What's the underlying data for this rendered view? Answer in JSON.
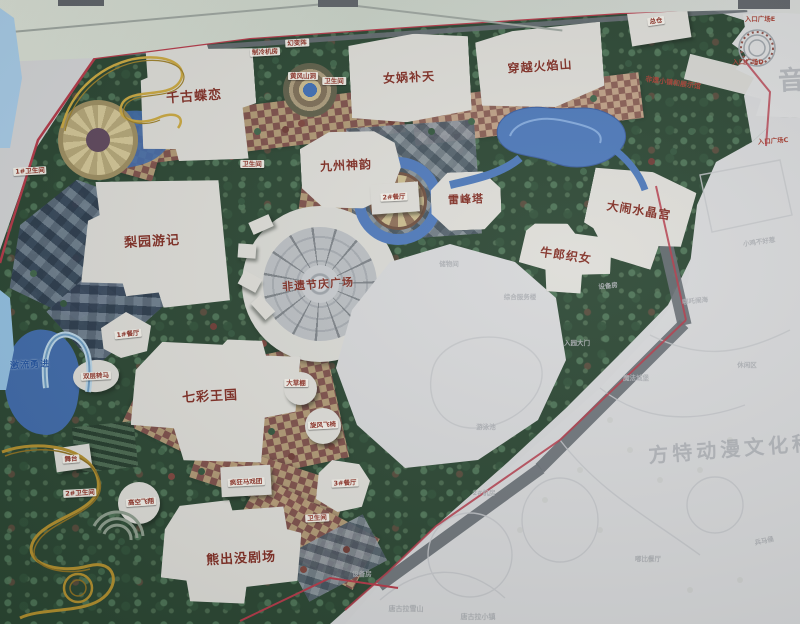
{
  "watermarks": {
    "main": "方特动漫文化科技",
    "edge_partial": "音"
  },
  "colors": {
    "park_green": "#24402c",
    "path_tan": "#b59a74",
    "path_maroon": "#7e4b46",
    "water_blue": "#4673b6",
    "boundary_red": "#b23343",
    "building_white": "#dcdbd6",
    "label_red": "#7c271d",
    "faint_grey": "#a9acb1",
    "coaster_gold": "#c9a53a"
  },
  "labels": {
    "major": [
      {
        "name": "qiangu-dielian",
        "t": "千古蝶恋",
        "x": 194,
        "y": 95,
        "fs": 13,
        "rot": -4
      },
      {
        "name": "nvwa-butian",
        "t": "女娲补天",
        "x": 409,
        "y": 77,
        "fs": 12,
        "rot": -3
      },
      {
        "name": "chuanyue-huoyanshan",
        "t": "穿越火焰山",
        "x": 540,
        "y": 66,
        "fs": 12,
        "rot": -4
      },
      {
        "name": "jiuzhou-shenyun",
        "t": "九州神韵",
        "x": 346,
        "y": 165,
        "fs": 12,
        "rot": -3
      },
      {
        "name": "leifeng-ta",
        "t": "雷峰塔",
        "x": 466,
        "y": 199,
        "fs": 11,
        "rot": -2
      },
      {
        "name": "danao-shuijinggong",
        "t": "大闹水晶宫",
        "x": 639,
        "y": 210,
        "fs": 12,
        "rot": 9
      },
      {
        "name": "niulang-zhinv",
        "t": "牛郎织女",
        "x": 566,
        "y": 255,
        "fs": 12,
        "rot": 8
      },
      {
        "name": "liyuan-youji",
        "t": "梨园游记",
        "x": 152,
        "y": 240,
        "fs": 13,
        "rot": -3
      },
      {
        "name": "feiyi-jieqing-guangchang",
        "t": "非遗节庆广场",
        "x": 318,
        "y": 284,
        "fs": 11,
        "rot": -4
      },
      {
        "name": "qicai-wangguo",
        "t": "七彩王国",
        "x": 210,
        "y": 395,
        "fs": 13,
        "rot": -3
      },
      {
        "name": "xiongchumo-juchang",
        "t": "熊出没剧场",
        "x": 241,
        "y": 557,
        "fs": 13,
        "rot": -3
      }
    ],
    "tags": [
      {
        "name": "zhileng-jifang",
        "t": "制冷机房",
        "x": 265,
        "y": 52,
        "rot": -3
      },
      {
        "name": "huanbianzhen",
        "t": "幻变阵",
        "x": 297,
        "y": 43,
        "rot": -3
      },
      {
        "name": "huangfeng-shandong",
        "t": "黄风山洞",
        "x": 303,
        "y": 76,
        "rot": 0
      },
      {
        "name": "weishengjian-garden",
        "t": "卫生间",
        "x": 334,
        "y": 81,
        "rot": 0
      },
      {
        "name": "zongcang",
        "t": "总仓",
        "x": 656,
        "y": 21,
        "rot": -8
      },
      {
        "name": "weishengjian-1",
        "t": "1#卫生间",
        "x": 30,
        "y": 171,
        "rot": -3
      },
      {
        "name": "weishengjian-path",
        "t": "卫生间",
        "x": 252,
        "y": 164,
        "rot": 0
      },
      {
        "name": "canting-2",
        "t": "2#餐厅",
        "x": 394,
        "y": 197,
        "rot": -3
      },
      {
        "name": "canting-1",
        "t": "1#餐厅",
        "x": 128,
        "y": 334,
        "rot": -6
      },
      {
        "name": "shuangceng-zhuanma",
        "t": "双层转马",
        "x": 96,
        "y": 376,
        "rot": -3
      },
      {
        "name": "dacaopeng",
        "t": "大草棚",
        "x": 296,
        "y": 383,
        "rot": 0
      },
      {
        "name": "xuanfeng-feiyi",
        "t": "旋风飞椅",
        "x": 323,
        "y": 425,
        "rot": -3
      },
      {
        "name": "wutai",
        "t": "舞台",
        "x": 71,
        "y": 459,
        "rot": -5
      },
      {
        "name": "weishengjian-2",
        "t": "2#卫生间",
        "x": 80,
        "y": 493,
        "rot": -3
      },
      {
        "name": "gaokong-feixiang",
        "t": "高空飞翔",
        "x": 141,
        "y": 502,
        "rot": -4
      },
      {
        "name": "fengkuang-maxituan",
        "t": "疯狂马戏团",
        "x": 246,
        "y": 482,
        "rot": -3
      },
      {
        "name": "canting-3",
        "t": "3#餐厅",
        "x": 345,
        "y": 483,
        "rot": -3
      },
      {
        "name": "weishengjian-3",
        "t": "卫生间",
        "x": 317,
        "y": 518,
        "rot": -3
      }
    ],
    "plain": [
      {
        "name": "feiyi-xiaozhen-zhanshiguan",
        "t": "非遗小镇和展示馆",
        "x": 673,
        "y": 83,
        "fs": 7,
        "rot": 8
      },
      {
        "name": "rukou-guangchang-e",
        "t": "入口广场E",
        "x": 760,
        "y": 18,
        "fs": 6.5,
        "rot": 0
      },
      {
        "name": "rukou-guangchang-d",
        "t": "入口广场D",
        "x": 748,
        "y": 61,
        "fs": 6.5,
        "rot": 0
      },
      {
        "name": "rukou-guangchang-c",
        "t": "入口广场C",
        "x": 773,
        "y": 140,
        "fs": 6.5,
        "rot": -4
      }
    ],
    "blue": [
      {
        "name": "jiliu-yongjin",
        "t": "激流勇进",
        "x": 30,
        "y": 364,
        "fs": 9,
        "rot": -3
      }
    ],
    "faint": [
      {
        "name": "chuwujian",
        "t": "储物间",
        "x": 449,
        "y": 263,
        "rot": 0
      },
      {
        "name": "zonghe-fuwulou",
        "t": "综合服务楼",
        "x": 520,
        "y": 296,
        "rot": 0
      },
      {
        "name": "ruyuan-damen",
        "t": "入园大门",
        "x": 577,
        "y": 342,
        "rot": 0
      },
      {
        "name": "shebeifang-1",
        "t": "设备房",
        "x": 608,
        "y": 285,
        "rot": -6
      },
      {
        "name": "nezha-naohai",
        "t": "哪吒闹海",
        "x": 695,
        "y": 300,
        "rot": -6
      },
      {
        "name": "xiaoji-buhaore",
        "t": "小鸡不好惹",
        "x": 759,
        "y": 241,
        "rot": -8
      },
      {
        "name": "xiuxianqu",
        "t": "休闲区",
        "x": 747,
        "y": 364,
        "rot": 0
      },
      {
        "name": "mofa-chengbao",
        "t": "魔法城堡",
        "x": 636,
        "y": 377,
        "rot": 0
      },
      {
        "name": "jifang-2",
        "t": "2#机房",
        "x": 484,
        "y": 492,
        "rot": 0
      },
      {
        "name": "shebeifang-2",
        "t": "设备房",
        "x": 362,
        "y": 573,
        "rot": 0
      },
      {
        "name": "youyongchi",
        "t": "游泳池",
        "x": 486,
        "y": 426,
        "rot": 0
      },
      {
        "name": "tanggula-xueshan",
        "t": "唐古拉雪山",
        "x": 406,
        "y": 609,
        "fs": 7,
        "rot": 0
      },
      {
        "name": "tanggula-xiaozhen",
        "t": "唐古拉小镇",
        "x": 478,
        "y": 617,
        "fs": 7,
        "rot": 0
      },
      {
        "name": "bingmayong",
        "t": "兵马俑",
        "x": 764,
        "y": 540,
        "rot": -12
      },
      {
        "name": "dubi-canting",
        "t": "嘟比餐厅",
        "x": 648,
        "y": 558,
        "rot": 0
      }
    ]
  }
}
